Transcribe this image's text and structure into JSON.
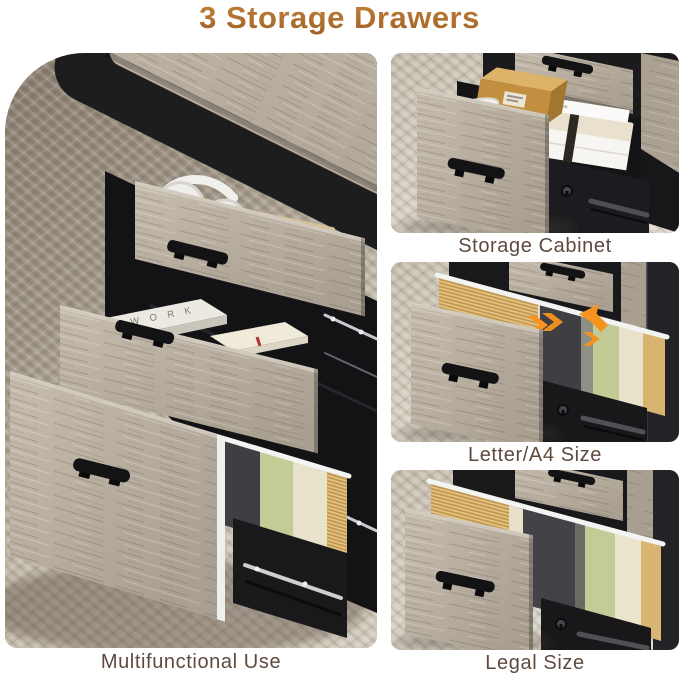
{
  "title": {
    "text": "3 Storage Drawers"
  },
  "panels": {
    "main": {
      "caption": "Multifunctional Use",
      "book_spine_top_drawer": "FIELD",
      "book_spine_middle_drawer": "W O R K"
    },
    "storage_cabinet": {
      "caption": "Storage Cabinet"
    },
    "letter_a4": {
      "caption": "Letter/A4 Size"
    },
    "legal": {
      "caption": "Legal Size"
    }
  },
  "colors": {
    "background": "#ffffff",
    "title_gradient_top": "#c5823c",
    "title_gradient_bottom": "#9c5e22",
    "caption_text": "#5e4a3f",
    "arrow_accent": "#f6931e",
    "furniture_black": "#1d1d20",
    "wood_grey": "#b7ae9f",
    "carpet_beige": "#cdc5b7",
    "file_folder_tan": "#d8b16b",
    "file_folder_green": "#c3cc97",
    "file_folder_cream": "#e9e2cb",
    "file_folder_black": "#3f3f43"
  }
}
